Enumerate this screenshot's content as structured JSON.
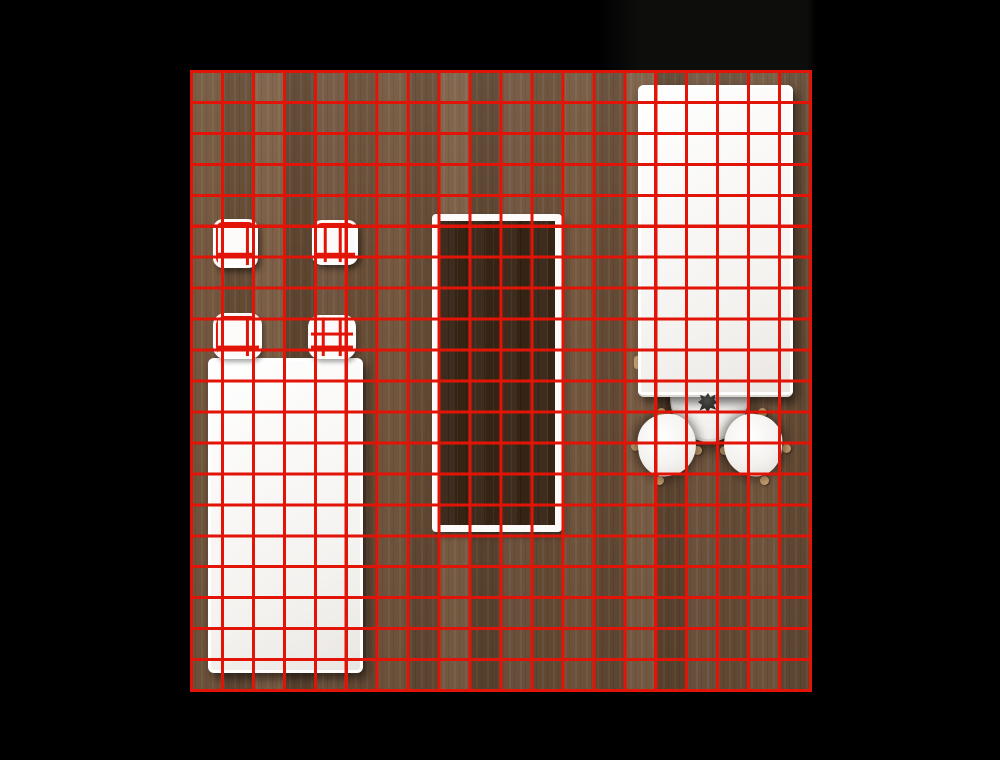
{
  "scene": {
    "view": "top-down room plan",
    "room": {
      "floor_material": "wood planks",
      "grid": {
        "columns": 20,
        "rows": 20,
        "cell_px": 31,
        "line_px": 3
      }
    },
    "objects": [
      {
        "id": "stool-left",
        "kind": "small square stool"
      },
      {
        "id": "stool-right",
        "kind": "small square stool"
      },
      {
        "id": "bed",
        "kind": "bed with two pillows"
      },
      {
        "id": "rug",
        "kind": "dark rug with white border"
      },
      {
        "id": "long-table",
        "kind": "long white table"
      },
      {
        "id": "round-table",
        "kind": "round table, half tucked under long table"
      },
      {
        "id": "table-plant",
        "kind": "small dark plant on round table"
      },
      {
        "id": "chair-left",
        "kind": "white chair"
      },
      {
        "id": "chair-right",
        "kind": "white chair"
      }
    ]
  },
  "colors": {
    "bg": "#000000",
    "shade": "#0d0d0c",
    "grid": "#e11407",
    "floorA": "#6e5540",
    "floorB": "#74583f",
    "floorC": "#644b35",
    "floorD": "#7c5f46",
    "floorE": "#5d4530",
    "floorF": "#715640",
    "floorG": "#684e37",
    "rug": "#3a2a1b",
    "white": "#fcfbf9",
    "tan": "#c9a170",
    "plant": "#2d2c2a"
  }
}
